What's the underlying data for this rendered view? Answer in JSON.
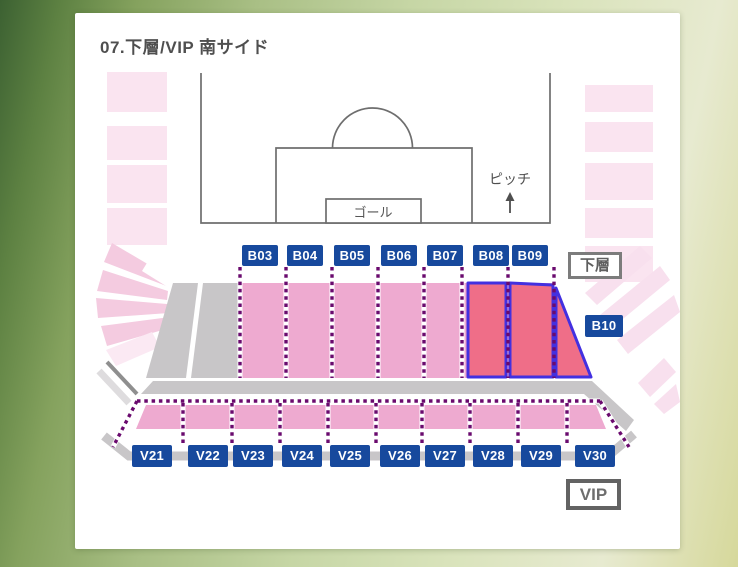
{
  "title": "07.下層/VIP 南サイド",
  "pitch": {
    "goal_label": "ゴール",
    "pitch_label": "ピッチ"
  },
  "tier_badges": {
    "lower": "下層",
    "vip": "VIP"
  },
  "b_sections": [
    "B03",
    "B04",
    "B05",
    "B06",
    "B07",
    "B08",
    "B09"
  ],
  "b10": "B10",
  "v_sections": [
    "V21",
    "V22",
    "V23",
    "V24",
    "V25",
    "V26",
    "V27",
    "V28",
    "V29",
    "V30"
  ],
  "selected_sections": [
    "B08",
    "B09",
    "B10"
  ],
  "colors": {
    "label_blue": "#17499d",
    "section_pink": "#eeaad0",
    "pale_pink": "#fae4f0",
    "fan_pink": "#f4cbe0",
    "selected_fill": "#ef6e88",
    "selected_outline": "#4330e0",
    "dotted_purple": "#6a0a6e",
    "walkway_gray": "#c8c6c8",
    "pitch_line_gray": "#6e6e6e"
  }
}
